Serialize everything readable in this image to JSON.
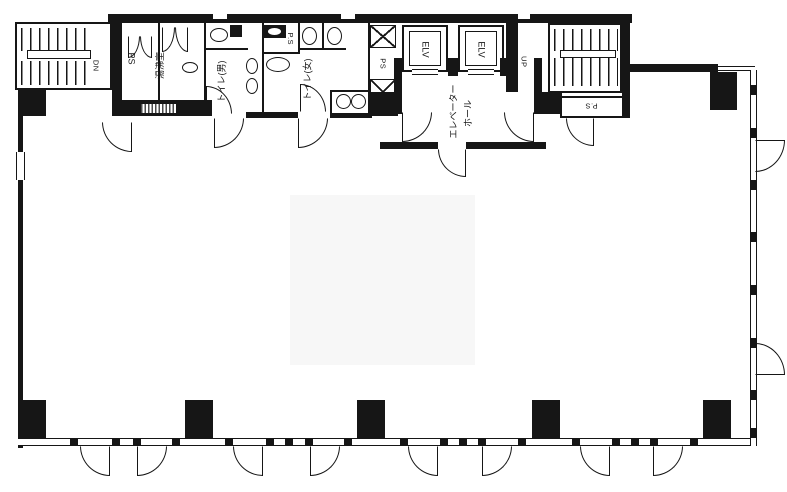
{
  "title": "building-floor-plan",
  "colors": {
    "line": "#161616",
    "background": "#ffffff",
    "wall": "#161616",
    "artifact": "#f7f7f7"
  },
  "labels": {
    "external_stair_dn": "DN",
    "ps_left": "PS",
    "kitchenette": "湯沸室",
    "toilet_men": "トイレ(男)",
    "ps_small": "P.S",
    "toilet_women": "トイレ(女)",
    "ps_shaft": "PS",
    "elevator_1": "ELV",
    "elevator_2": "ELV",
    "elevator_hall_line1": "エレベーター",
    "elevator_hall_line2": "ホール",
    "stair_up": "UP",
    "stair_dn": "DN",
    "ps_bottom": "P.S"
  }
}
